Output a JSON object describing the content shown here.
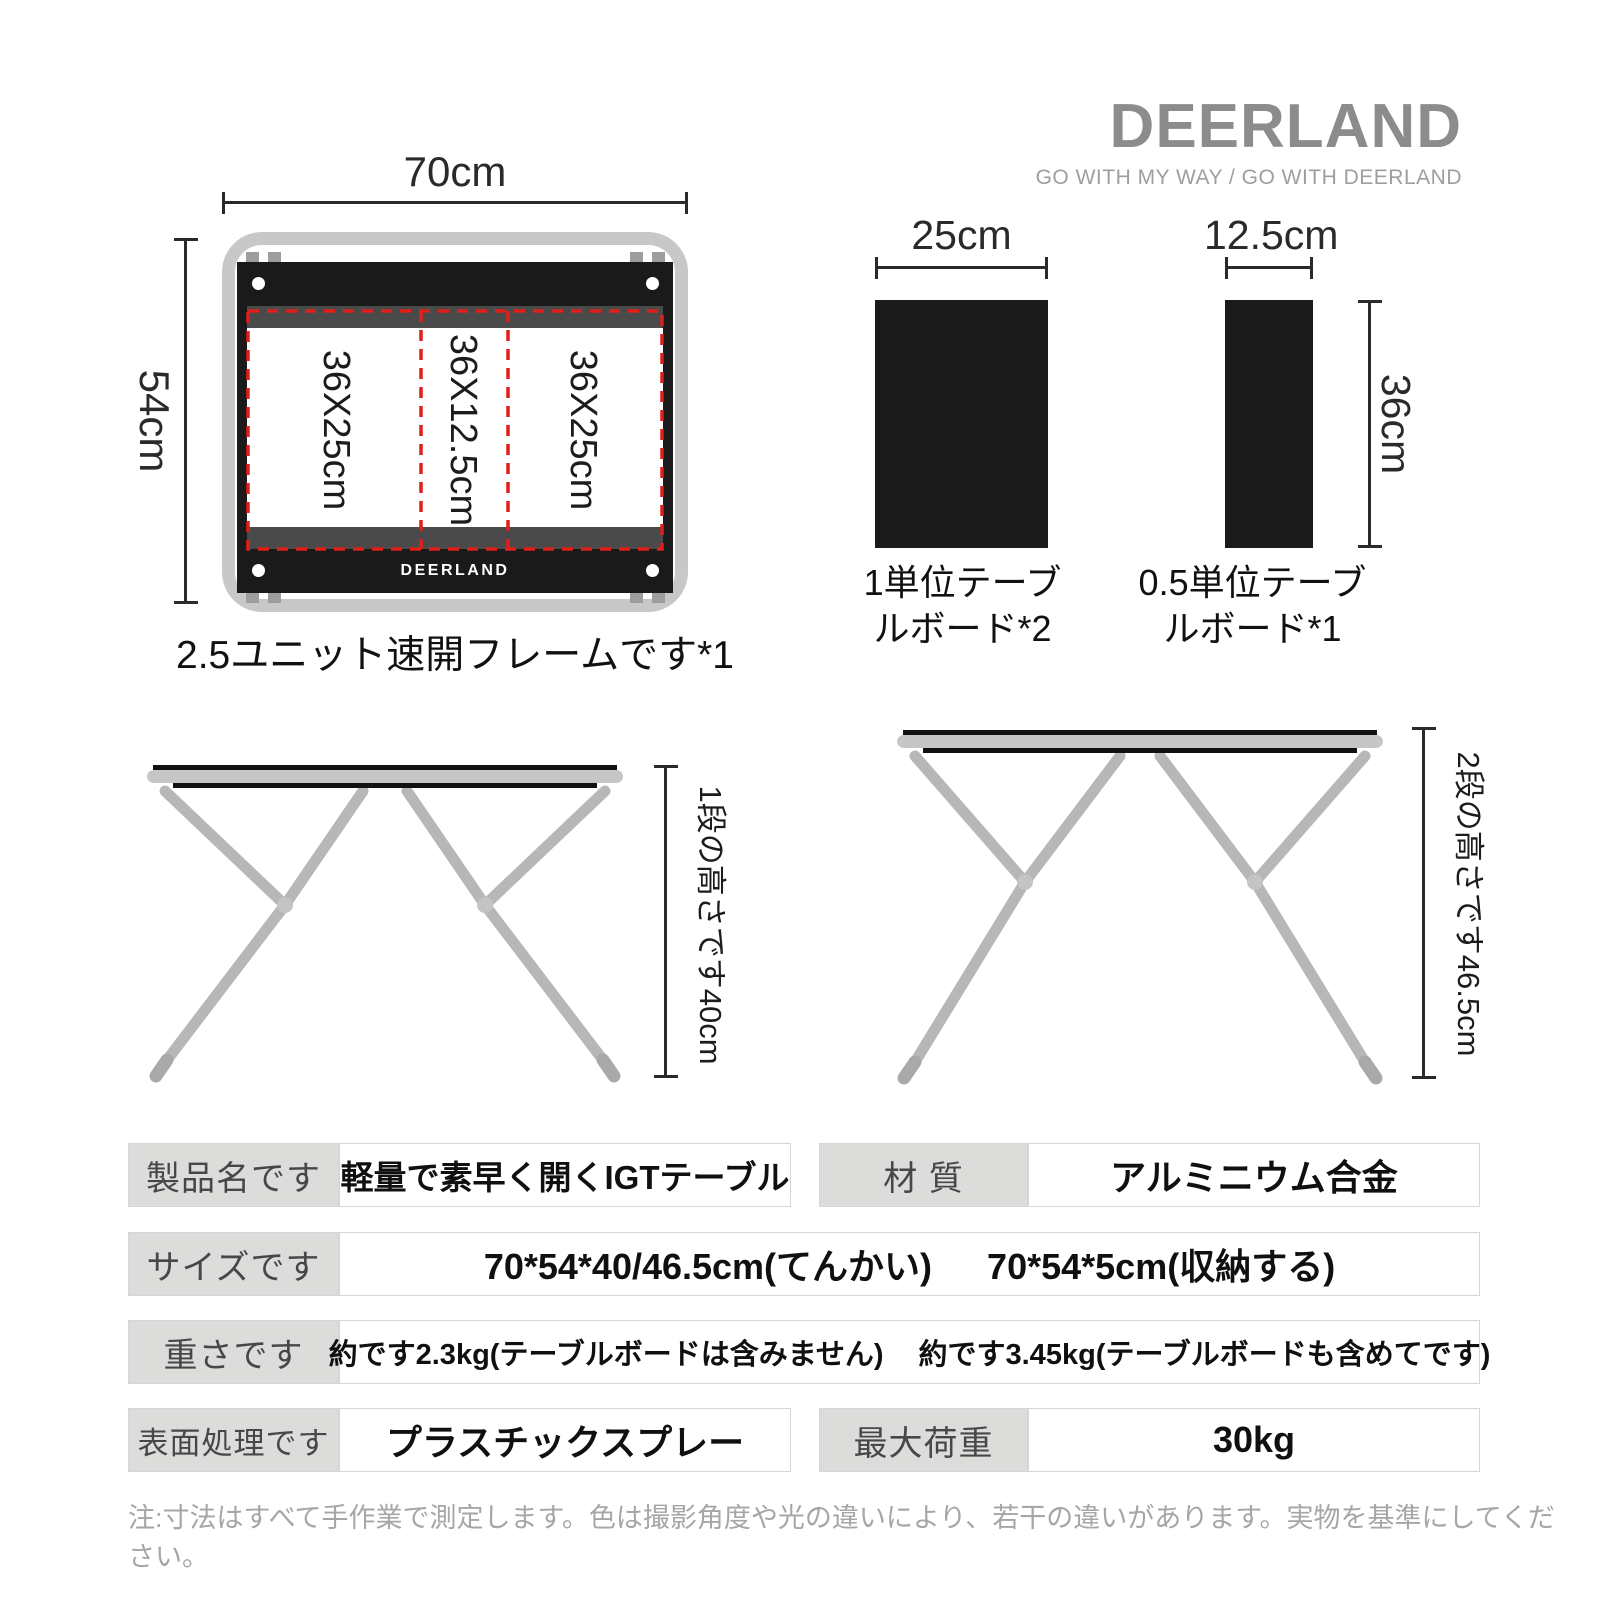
{
  "brand": {
    "logo": "DEERLAND",
    "tagline": "GO WITH MY WAY / GO WITH DEERLAND"
  },
  "frame_diagram": {
    "width_label": "70cm",
    "height_label": "54cm",
    "panels": [
      "36X25cm",
      "36X12.5cm",
      "36X25cm"
    ],
    "frame_brand": "DEERLAND",
    "caption": "2.5ユニット速開フレームです*1"
  },
  "boards": {
    "unit1": {
      "width_label": "25cm",
      "caption_line1": "1単位テーブ",
      "caption_line2": "ルボード*2"
    },
    "unit05": {
      "width_label": "12.5cm",
      "height_label": "36cm",
      "caption_line1": "0.5単位テーブ",
      "caption_line2": "ルボード*1"
    }
  },
  "tables": {
    "one_stage": {
      "height_label": "1段の高さです40cm"
    },
    "two_stage": {
      "height_label": "2段の高さです46.5cm"
    }
  },
  "specs": {
    "product_name": {
      "label": "製品名です",
      "value": "軽量で素早く開くIGTテーブル"
    },
    "material": {
      "label": "材 質",
      "value": "アルミニウム合金"
    },
    "size": {
      "label": "サイズです",
      "value1": "70*54*40/46.5cm(てんかい)",
      "value2": "70*54*5cm(収納する)"
    },
    "weight": {
      "label": "重さです",
      "value1": "約です2.3kg(テーブルボードは含みません)",
      "value2": "約です3.45kg(テーブルボードも含めてです)"
    },
    "surface": {
      "label": "表面処理です",
      "value": "プラスチックスプレー"
    },
    "max_load": {
      "label": "最大荷重",
      "value": "30kg"
    }
  },
  "note": "注:寸法はすべて手作業で測定します。色は撮影角度や光の違いにより、若干の違いがあります。実物を基準にしてください。",
  "colors": {
    "accent_red": "#e01e1a",
    "frame_gray": "#c8c8c8",
    "bar_black": "#1a1a1a",
    "strip_gray": "#4a4a4a",
    "leg_gray": "#b7b7b7",
    "label_bg": "#dcdcdb",
    "logo_gray": "#8c8c8c",
    "note_gray": "#a6a6a6"
  }
}
